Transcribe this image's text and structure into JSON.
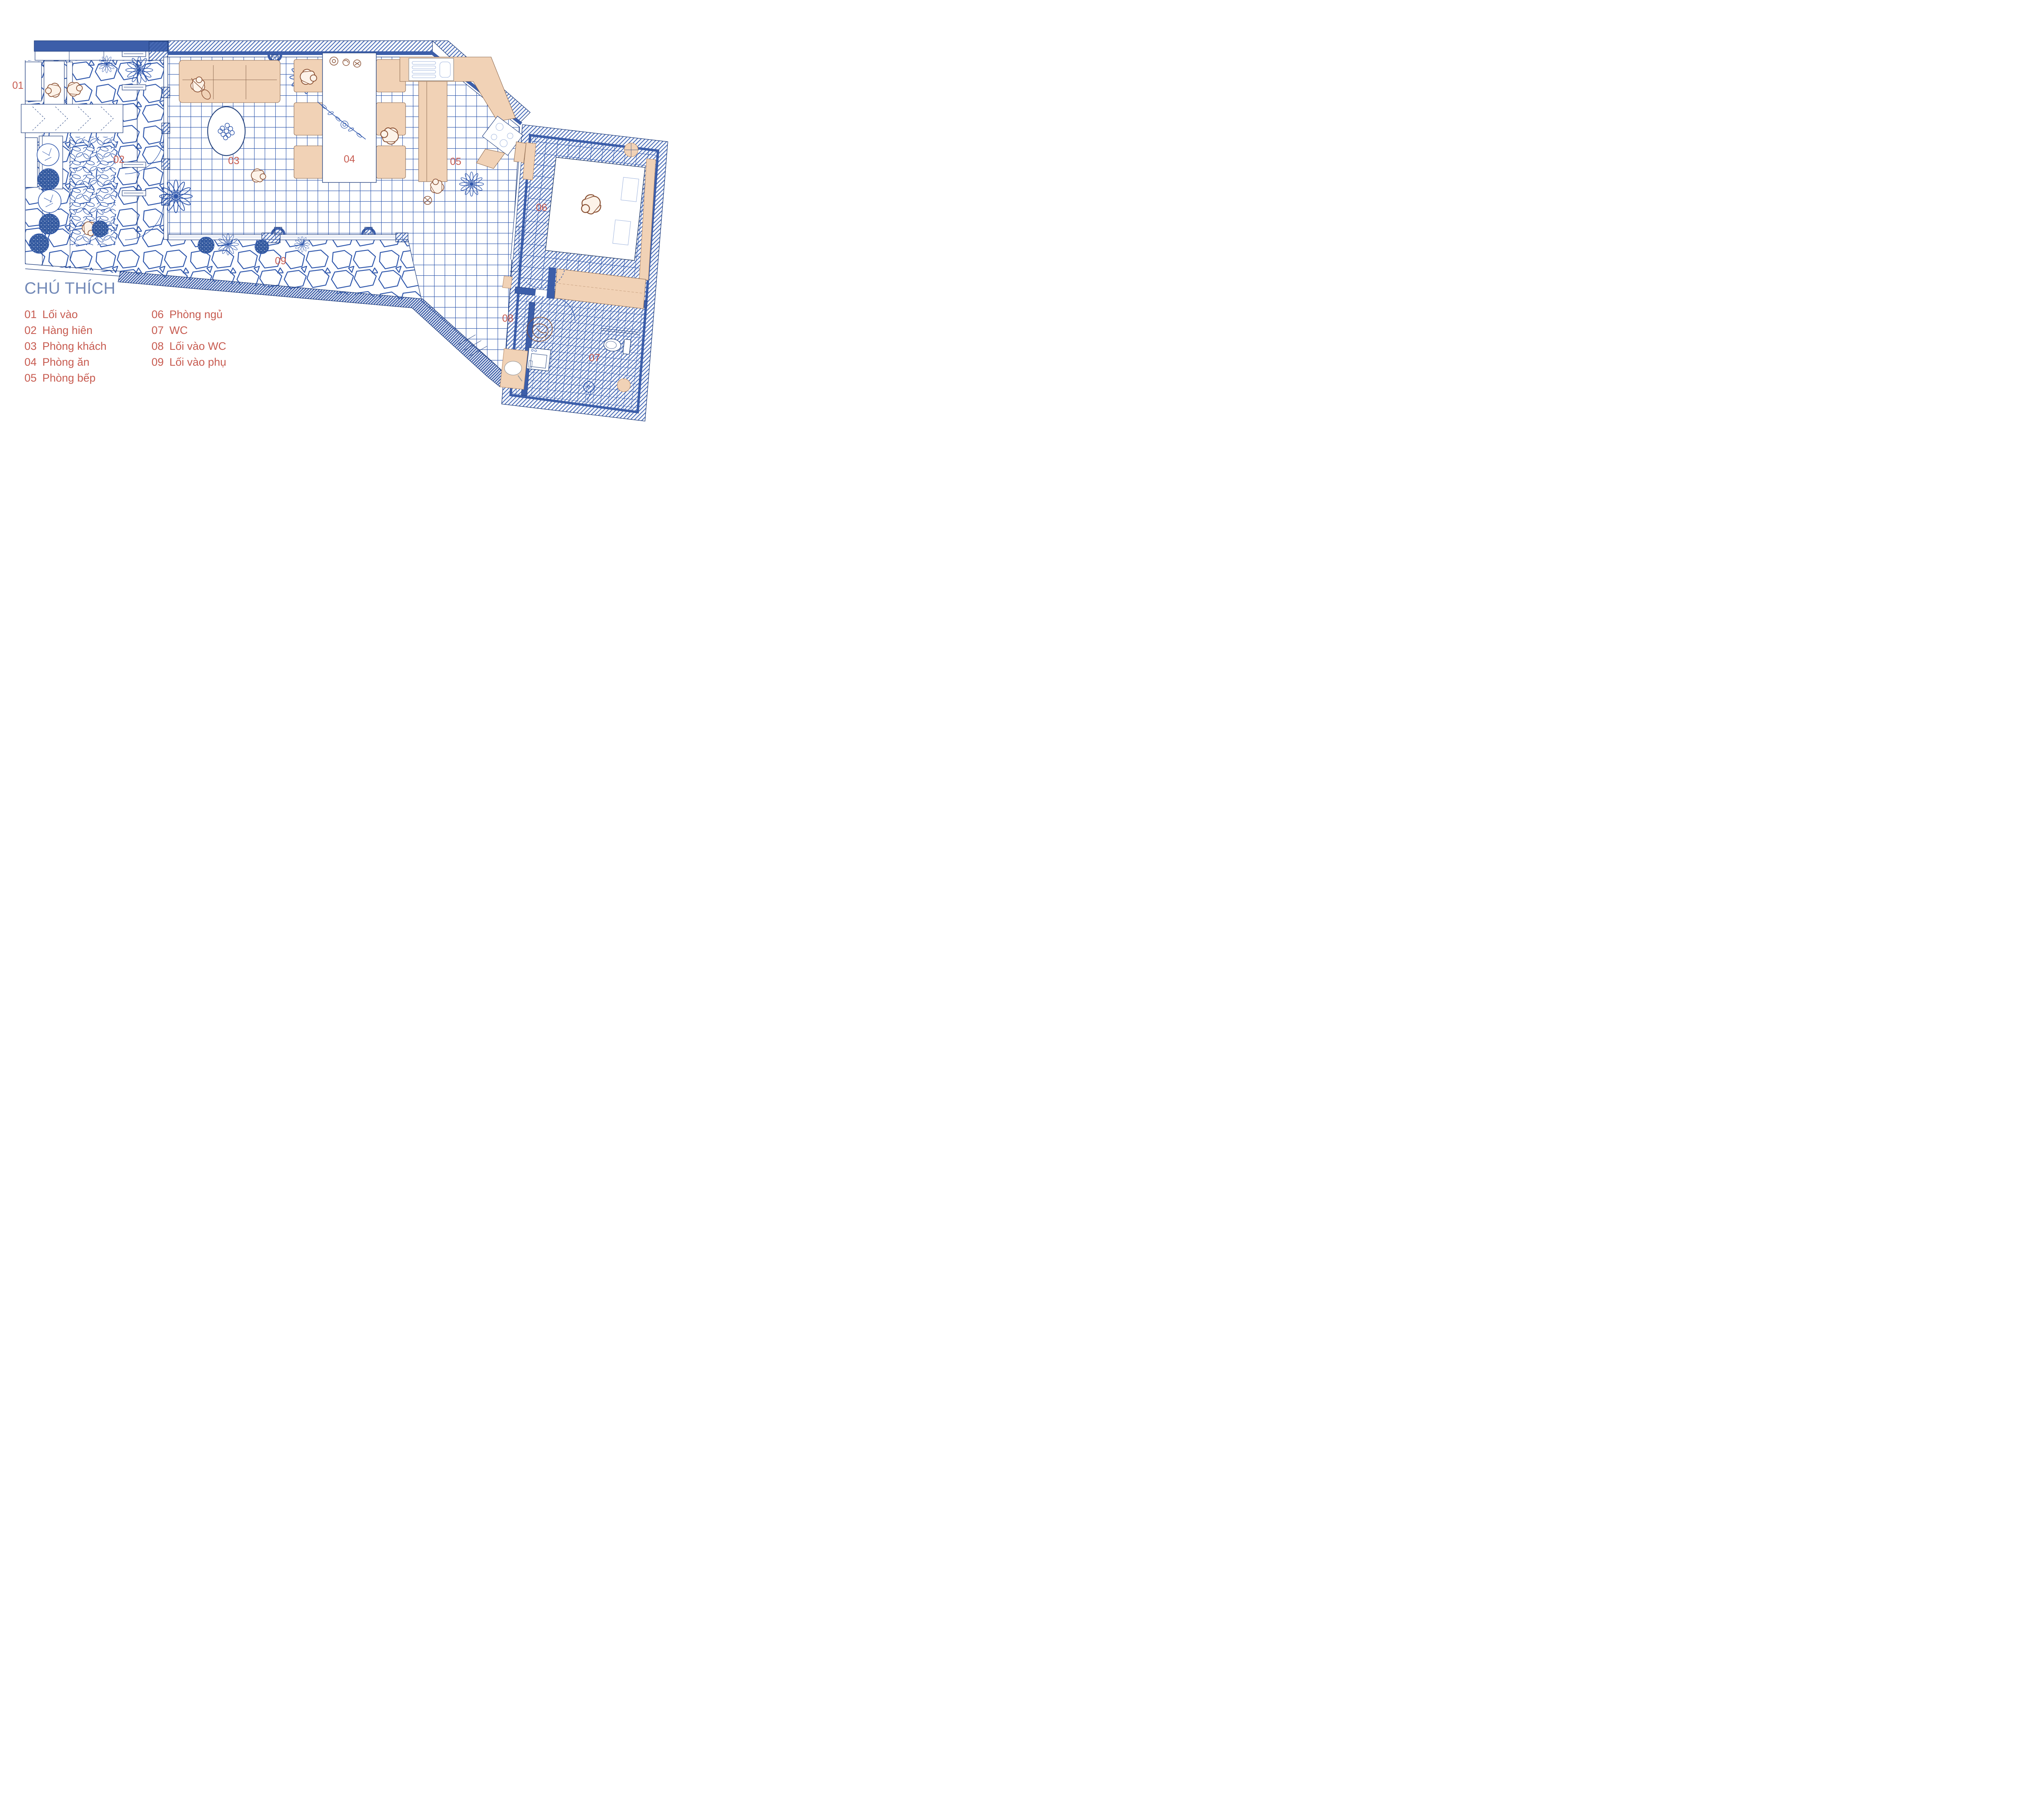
{
  "legend": {
    "title": "CHÚ THÍCH",
    "items": [
      {
        "num": "01",
        "label": "Lối vào"
      },
      {
        "num": "02",
        "label": "Hàng hiên"
      },
      {
        "num": "03",
        "label": "Phòng khách"
      },
      {
        "num": "04",
        "label": "Phòng ăn"
      },
      {
        "num": "05",
        "label": "Phòng bếp"
      },
      {
        "num": "06",
        "label": "Phòng ngủ"
      },
      {
        "num": "07",
        "label": "WC"
      },
      {
        "num": "08",
        "label": "Lối vào WC"
      },
      {
        "num": "09",
        "label": "Lối vào phụ"
      }
    ]
  },
  "plan": {
    "drawing_type": "apartment floor plan",
    "colors": {
      "wall": "#3c5ea9",
      "navy": "#1f3d7d",
      "line": "#2f57ac",
      "linel": "#9db3dd",
      "tan": "#f1d2b6",
      "tanline": "#b98f6d",
      "red": "#c75b50",
      "title": "#7289b7",
      "brown": "#8a5134",
      "leaf": "#33599f"
    }
  }
}
